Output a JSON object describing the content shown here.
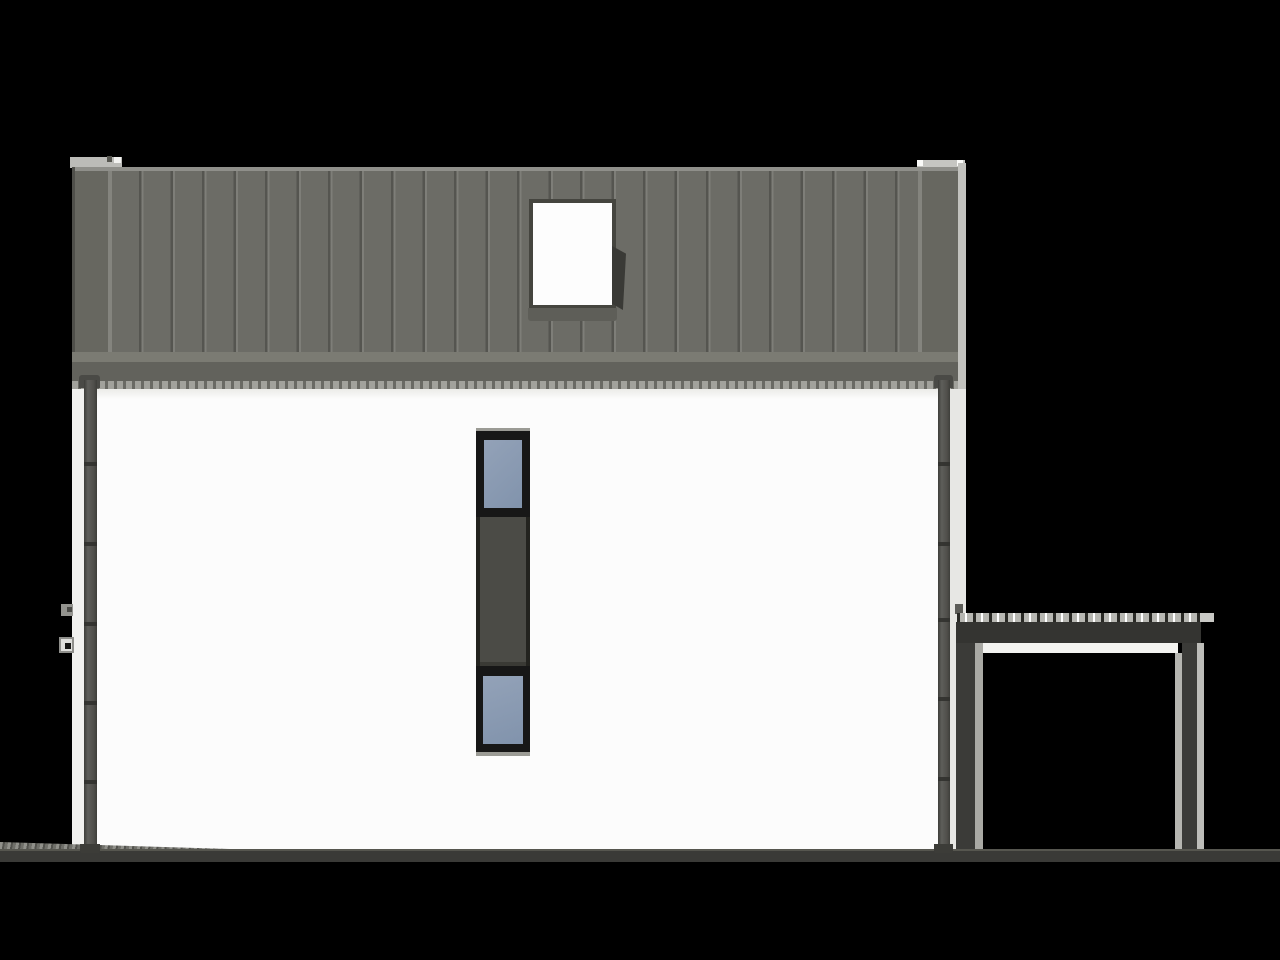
{
  "meta": {
    "kind": "architectural-elevation-render",
    "description": "Side elevation rendering of a modern house: dark standing-seam metal roof band with a roof window, white facade with a vertical stacked window strip, downpipes on both edges, and an attached flat-roof carport frame on the right, on a black background",
    "canvas": {
      "width": 1280,
      "height": 960
    }
  },
  "palette": {
    "bg": "#000000",
    "roof_field": "#6c6c66",
    "roof_barge": "#676760",
    "roof_top_line": "#8f8f8a",
    "roof_separator": "#84847e",
    "roof_edge_dark": "#4f4f4a",
    "roof_light_strip": "#7b7b73",
    "fascia": "#62625c",
    "gutter": "#a2a29c",
    "gutter_dash": "#6a6a64",
    "wall": "#fcfcfc",
    "wall_shade": "#ebebe8",
    "return_left": "#f1f1ef",
    "return_right": "#e7e7e4",
    "cap_left": "#bcbcb8",
    "cap_right": "#c6c6c2",
    "frame_dark": "#171717",
    "glass": "#8193ac",
    "glass_light": "#93a2b8",
    "mid_panel": "#4b4b46",
    "rail_dark": "#23231f",
    "sill_gray": "#9b9b95",
    "skylight_white": "#fdfdfd",
    "skylight_frame": "#45453f",
    "skylight_flap": "#3a3a36",
    "skylight_sill": "#5e5e58",
    "pipe_dark": "#3e3e3a",
    "pipe_mid": "#5e5e5a",
    "pipe_joint": "#31312e",
    "carport_beam": "#343431",
    "carport_post": "#3b3b38",
    "carport_post_light_left": "#a9a9a4",
    "carport_post_light_right": "#bdbdb9",
    "carport_speckle_base": "#b7b7b2",
    "carport_underline": "#f3f3f0",
    "carport_tail": "#c9c9c5",
    "ground": "#3a3a37",
    "ground_top": "#56564f"
  },
  "scene": {
    "house": {
      "roof": {
        "material": "standing-seam-metal",
        "seam_spacing_px": 31.5,
        "has_left_gable_cap": true,
        "has_right_gable_cap": true,
        "roof_window": {
          "glazing": "white",
          "has_right_flap": true,
          "has_sill_band": true
        }
      },
      "facade": {
        "color_key": "wall",
        "window_strip": {
          "orientation": "vertical",
          "segments": [
            "glazed-window-top",
            "dark-spandrel-panel",
            "glazed-window-bottom"
          ],
          "glass_color_key": "glass",
          "panel_color_key": "mid_panel"
        }
      },
      "downpipes": {
        "left": {
          "joint_offsets": [
            462,
            542,
            622,
            701,
            780
          ]
        },
        "right": {
          "joint_offsets": [
            462,
            542,
            618,
            697,
            777
          ]
        },
        "wall_brackets": 2
      }
    },
    "carport": {
      "style": "open-flat-roof-frame",
      "posts": 2,
      "speckled_roof_edge": true
    },
    "ground": {
      "band": true,
      "left_texture_wedge": true
    }
  }
}
